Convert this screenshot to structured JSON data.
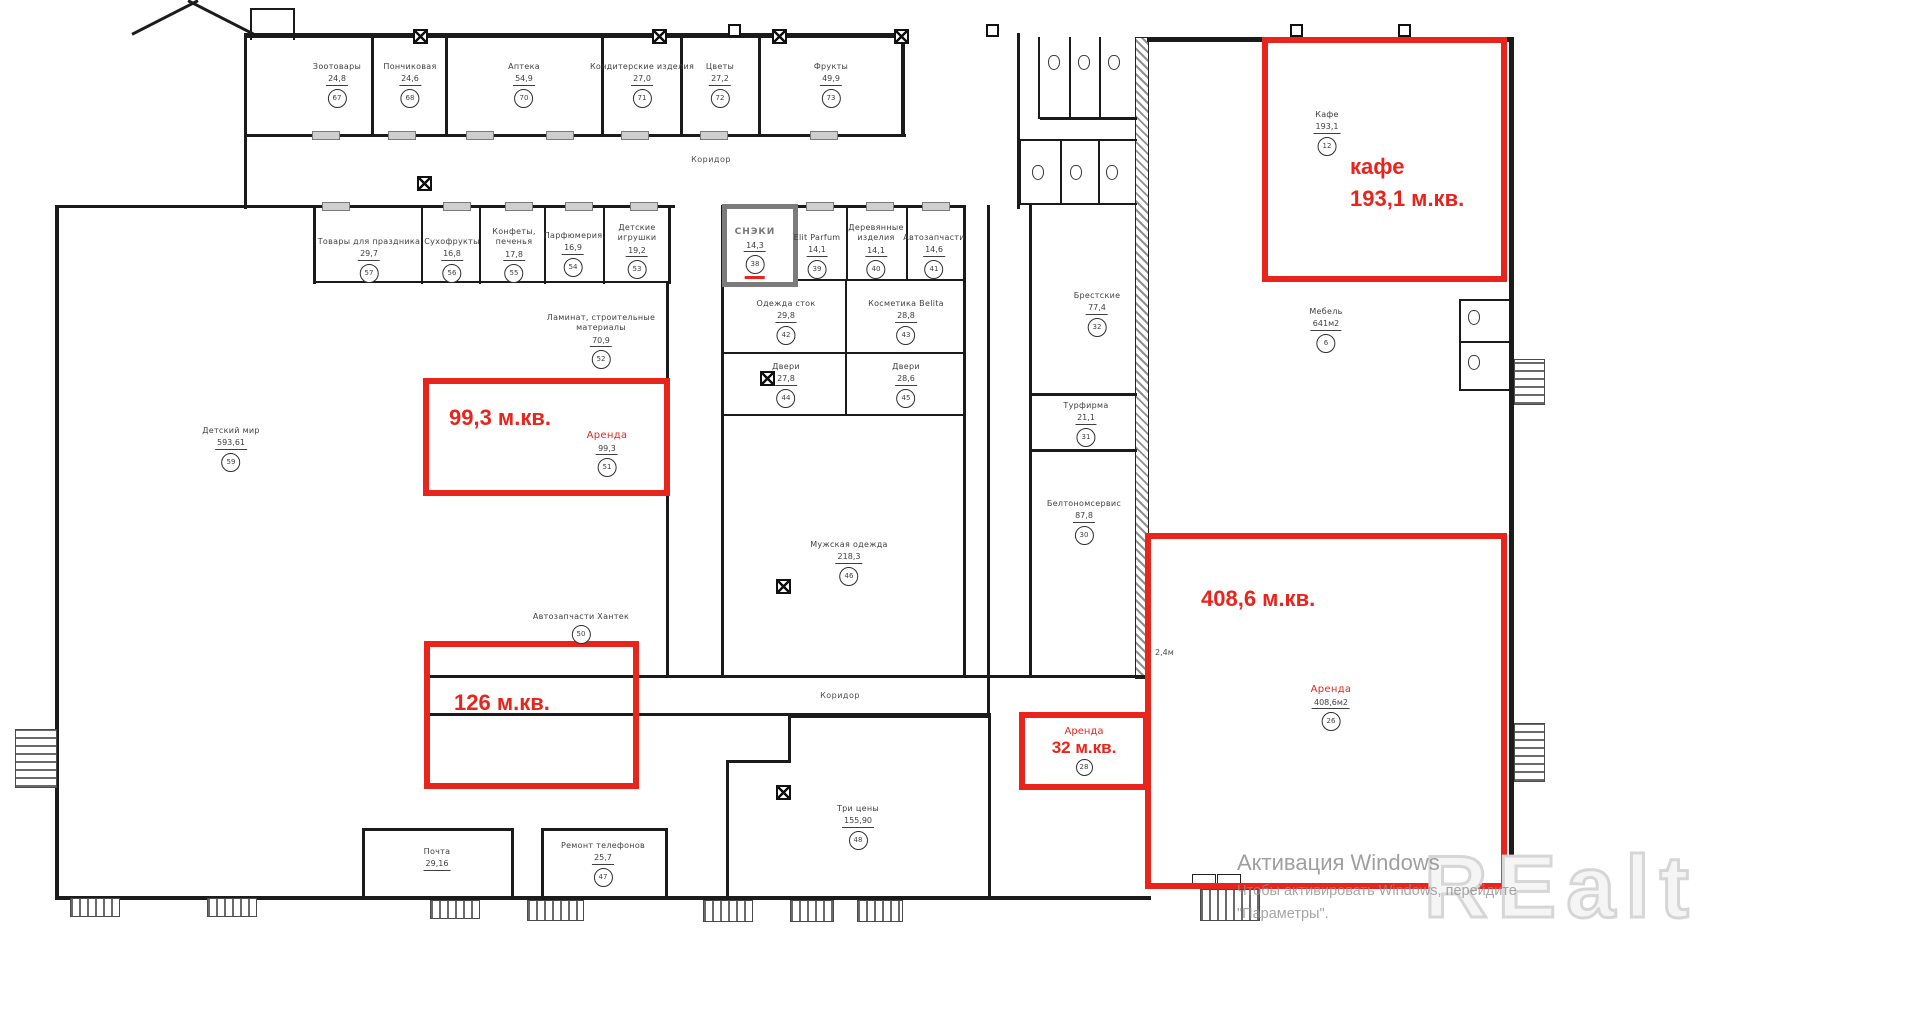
{
  "colors": {
    "red": "#e8241c",
    "wall": "#1b1b1b",
    "label_gray": "#3f3f3f",
    "snack_gray": "#787878",
    "watermark_gray": "#d6d6d6"
  },
  "corridors": [
    {
      "label": "Коридор",
      "x": 711,
      "y": 155
    },
    {
      "label": "Коридор",
      "x": 840,
      "y": 691
    }
  ],
  "dim_note": {
    "text": "2,4м",
    "x": 1155,
    "y": 648
  },
  "rooms": [
    {
      "name": "Зоотовары",
      "area": "24,8",
      "num": "67",
      "cx": 337,
      "y": 62
    },
    {
      "name": "Пончиковая",
      "area": "24,6",
      "num": "68",
      "cx": 410,
      "y": 62
    },
    {
      "name": "Аптека",
      "area": "54,9",
      "num": "70",
      "cx": 524,
      "y": 62
    },
    {
      "name": "Кондитерские изделия",
      "area": "27,0",
      "num": "71",
      "cx": 642,
      "y": 62
    },
    {
      "name": "Цветы",
      "area": "27,2",
      "num": "72",
      "cx": 720,
      "y": 62
    },
    {
      "name": "Фрукты",
      "area": "49,9",
      "num": "73",
      "cx": 831,
      "y": 62
    },
    {
      "name": "Товары для праздника",
      "area": "29,7",
      "num": "57",
      "cx": 369,
      "y": 237
    },
    {
      "name": "Сухофрукты",
      "area": "16,8",
      "num": "56",
      "cx": 452,
      "y": 237
    },
    {
      "name": "Конфеты,",
      "name2": "печенья",
      "area": "17,8",
      "num": "55",
      "cx": 514,
      "y": 227
    },
    {
      "name": "Парфюмерия",
      "area": "16,9",
      "num": "54",
      "cx": 573,
      "y": 231
    },
    {
      "name": "Детские",
      "name2": "игрушки",
      "area": "19,2",
      "num": "53",
      "cx": 637,
      "y": 223
    },
    {
      "name": "СНЭКИ",
      "area": "14,3",
      "num": "38",
      "cx": 755,
      "y": 227,
      "style": "snack"
    },
    {
      "name": "Elit Parfum",
      "area": "14,1",
      "num": "39",
      "cx": 817,
      "y": 233
    },
    {
      "name": "Деревянные",
      "name2": "изделия",
      "area": "14,1",
      "num": "40",
      "cx": 876,
      "y": 223
    },
    {
      "name": "Автозапчасти",
      "area": "14,6",
      "num": "41",
      "cx": 934,
      "y": 233
    },
    {
      "name": "Одежда  сток",
      "area": "29,8",
      "num": "42",
      "cx": 786,
      "y": 299
    },
    {
      "name": "Косметика  Belita",
      "area": "28,8",
      "num": "43",
      "cx": 906,
      "y": 299
    },
    {
      "name": "Двери",
      "area": "27,8",
      "num": "44",
      "cx": 786,
      "y": 362
    },
    {
      "name": "Двери",
      "area": "28,6",
      "num": "45",
      "cx": 906,
      "y": 362
    },
    {
      "name": "Мужская   одежда",
      "area": "218,3",
      "num": "46",
      "cx": 849,
      "y": 540
    },
    {
      "name": "Три  цены",
      "area": "155,90",
      "num": "48",
      "cx": 858,
      "y": 804
    },
    {
      "name": "Ремонт телефонов",
      "area": "25,7",
      "num": "47",
      "cx": 603,
      "y": 841
    },
    {
      "name": "Почта",
      "area": "29,16",
      "cx": 437,
      "y": 847
    },
    {
      "name": "Детский  мир",
      "area": "593,61",
      "num": "59",
      "cx": 231,
      "y": 426
    },
    {
      "name": "Ламинат, строительные",
      "name2": "материалы",
      "area": "70,9",
      "num": "52",
      "cx": 601,
      "y": 313
    },
    {
      "name": "Автозапчасти  Хантек",
      "num": "50",
      "cx": 581,
      "y": 612
    },
    {
      "name": "Брестские",
      "area": "77,4",
      "num": "32",
      "cx": 1097,
      "y": 291
    },
    {
      "name": "Турфирма",
      "area": "21,1",
      "num": "31",
      "cx": 1086,
      "y": 401
    },
    {
      "name": "Белтономсервис",
      "area": "87,8",
      "num": "30",
      "cx": 1084,
      "y": 499
    },
    {
      "name": "Кафе",
      "area": "193,1",
      "num": "12",
      "cx": 1327,
      "y": 110
    },
    {
      "name": "Мебель",
      "area": "641м2",
      "num": "6",
      "cx": 1326,
      "y": 307
    },
    {
      "name": "Аренда",
      "area": "99,3",
      "num": "51",
      "cx": 607,
      "y": 429,
      "style": "red"
    },
    {
      "name": "Аренда",
      "area": "408,6м2",
      "num": "26",
      "cx": 1331,
      "y": 683,
      "style": "red"
    }
  ],
  "red_zones": [
    {
      "id": "zone-99",
      "label": "99,3 м.кв.",
      "x": 423,
      "y": 378,
      "w": 247,
      "h": 118,
      "lx": 20,
      "ly": 18
    },
    {
      "id": "zone-126",
      "label": "126 м.кв.",
      "x": 424,
      "y": 641,
      "w": 215,
      "h": 148,
      "lx": 24,
      "ly": 40
    },
    {
      "id": "zone-408",
      "label": "408,6 м.кв.",
      "x": 1145,
      "y": 533,
      "w": 362,
      "h": 356,
      "lx": 50,
      "ly": 44
    },
    {
      "id": "zone-cafe",
      "label": "кафе",
      "label2": "193,1 м.кв.",
      "x": 1262,
      "y": 37,
      "w": 245,
      "h": 245,
      "lx": 82,
      "ly": 108
    },
    {
      "id": "zone-32",
      "label": "32 м.кв.",
      "sub": "Аренда",
      "num": "28",
      "x": 1019,
      "y": 712,
      "w": 130,
      "h": 78,
      "type": "zone32"
    }
  ],
  "windows_activation": {
    "title": "Активация Windows",
    "line2": "Чтобы активировать Windows, перейдите",
    "line3": "\"Параметры\"."
  },
  "watermark": "REalt"
}
